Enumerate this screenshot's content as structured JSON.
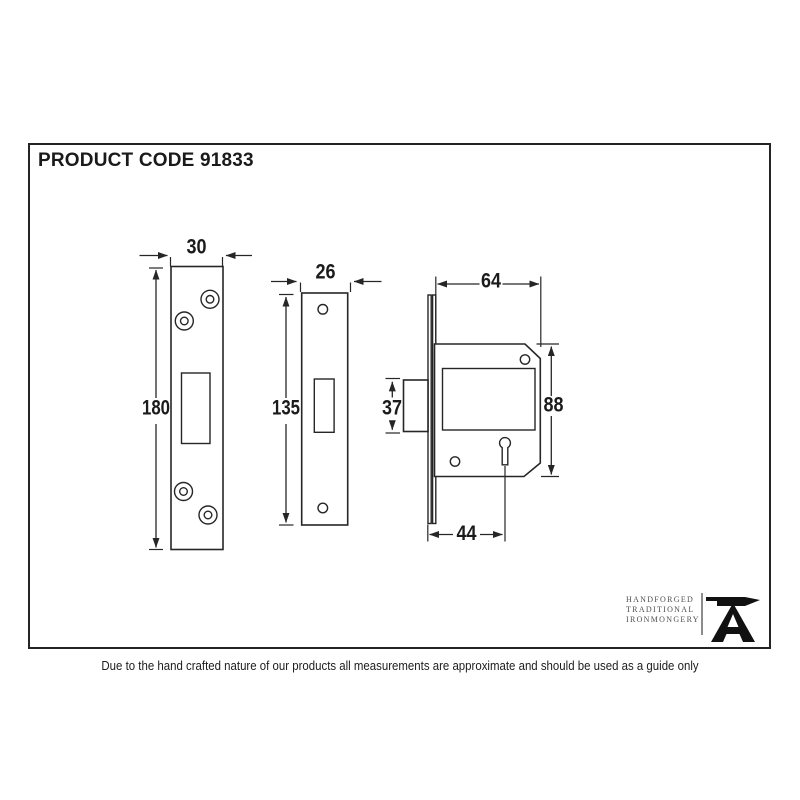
{
  "header": {
    "product_code": "PRODUCT CODE 91833"
  },
  "diagram": {
    "strike_plate": {
      "width": "30",
      "height": "180"
    },
    "faceplate": {
      "width": "26",
      "height": "135"
    },
    "lock_case": {
      "body_width": "64",
      "body_height": "88",
      "bolt_height": "37",
      "backset": "44"
    }
  },
  "branding": {
    "line1": "HANDFORGED",
    "line2": "TRADITIONAL",
    "line3": "IRONMONGERY",
    "logo": "anvil-icon"
  },
  "footer": {
    "disclaimer": "Due to the hand crafted nature of our products all measurements are approximate and should be used as a guide only"
  },
  "colors": {
    "ink": "#262626",
    "frame_border": "#242424",
    "brand_text": "#4f4f4f",
    "divider": "#8c8c8c",
    "background": "#ffffff"
  }
}
